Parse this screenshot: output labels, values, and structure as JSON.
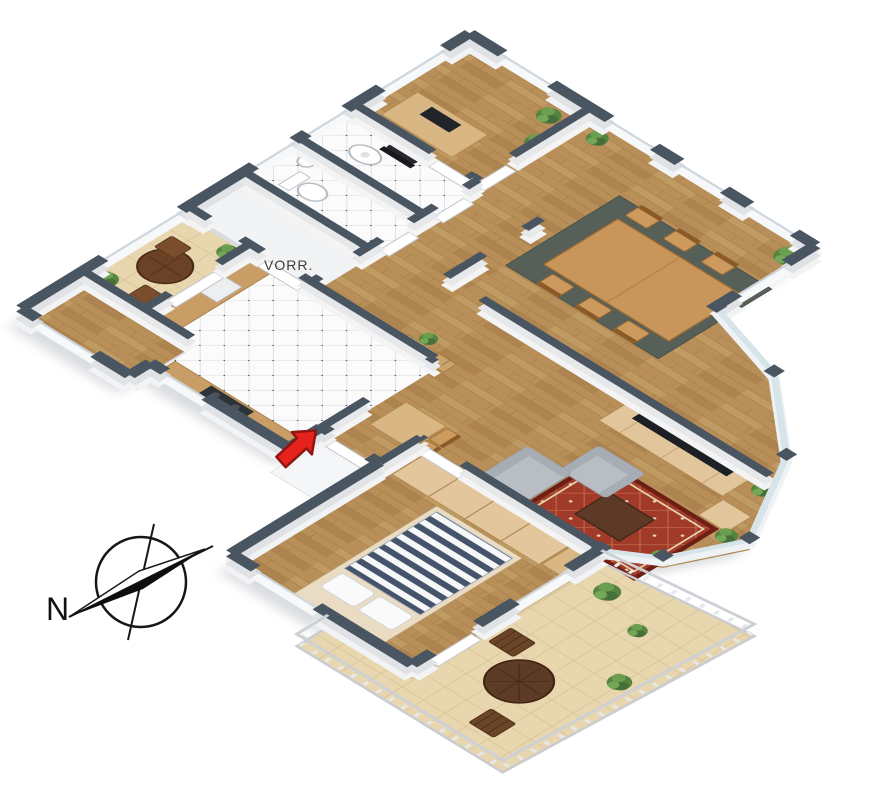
{
  "floorplan": {
    "type": "3d-isometric-floor-plan",
    "labels": {
      "vorraum": "VORR.",
      "compass_north": "N"
    },
    "rooms_depicted": {
      "office": "desk, office chair, two potted plants",
      "bathroom": "washbasin, tiled floor",
      "wc": "toilet, small washbasin, tiled floor",
      "vorraum": "anteroom with label",
      "kitchen": "tiled floor, counters, stove, sink",
      "pantry": "wood floor",
      "balcony": "round table, two chairs, plants, tiled floor",
      "dining_room": "table with six chairs, dark rug, plants",
      "living_room": "tv console, tv, sofa, armchair, red rug, coffee table, bay windows, plants",
      "bedroom": "double bed with striped duvet, wardrobes",
      "terrace": "round table, two chairs, plants, railing"
    },
    "markers": {
      "entrance_arrow": "red arrow pointing to entrance door",
      "compass": "compass rose with needle and N label"
    },
    "colors": {
      "wall_cap": "#4a5562",
      "wall_side": "#e3e5e8",
      "wood_floor": "#b88f58",
      "tile_floor": "#fbfbfc",
      "terrace_tile": "#e8d6ae",
      "dining_rug": "#565f58",
      "living_rug": "#a13a28",
      "sofa_gray": "#b9bec4",
      "furniture_wood": "#d9b784",
      "dark_table_wood": "#5e3b24",
      "bed_stripe": "#45546a",
      "plant_green": "#55843f",
      "arrow_red": "#e5231c",
      "compass_ink": "#111111",
      "label_ink": "#3c3c3c"
    }
  }
}
